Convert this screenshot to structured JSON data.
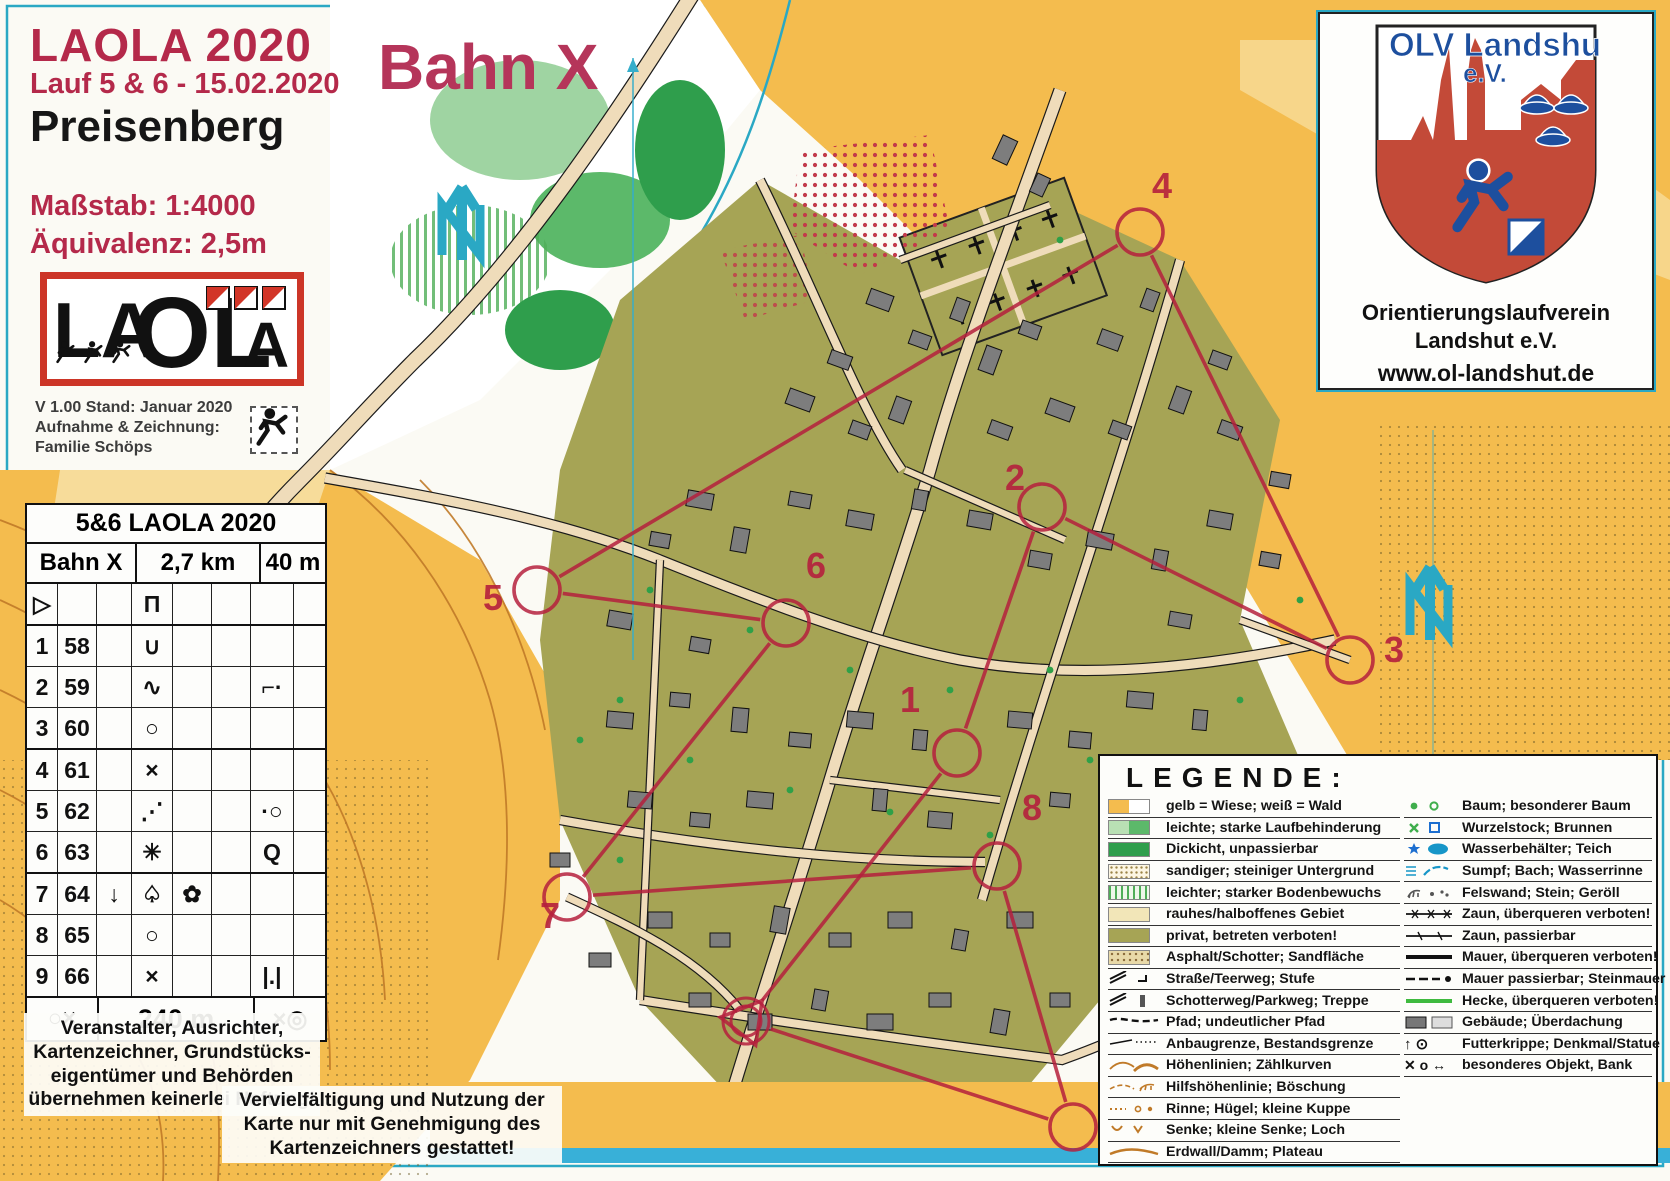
{
  "header": {
    "title": "LAOLA 2020",
    "subtitle": "Lauf 5 & 6 - 15.02.2020",
    "place": "Preisenberg",
    "scale": "Maßstab: 1:4000",
    "equivalence": "Äquivalenz: 2,5m"
  },
  "course_title": "Bahn X",
  "logo": {
    "part1": "LA",
    "part2": "OL",
    "part3": "A"
  },
  "version": {
    "line1": "V 1.00 Stand: Januar 2020",
    "line2": "Aufnahme & Zeichnung:",
    "line3": "Familie Schöps"
  },
  "control_card": {
    "title": "5&6 LAOLA 2020",
    "course": "Bahn X",
    "length": "2,7 km",
    "climb": "40 m",
    "rows": [
      {
        "num": "",
        "code": "",
        "c": "",
        "d": "Π",
        "e": "",
        "g": "",
        "start": true
      },
      {
        "num": "1",
        "code": "58",
        "c": "",
        "d": "∪",
        "e": "",
        "g": ""
      },
      {
        "num": "2",
        "code": "59",
        "c": "",
        "d": "∿",
        "e": "",
        "g": "⌐·"
      },
      {
        "num": "3",
        "code": "60",
        "c": "",
        "d": "○",
        "e": "",
        "g": ""
      },
      {
        "num": "4",
        "code": "61",
        "c": "",
        "d": "×",
        "e": "",
        "g": ""
      },
      {
        "num": "5",
        "code": "62",
        "c": "",
        "d": "⋰",
        "e": "",
        "g": "·○"
      },
      {
        "num": "6",
        "code": "63",
        "c": "",
        "d": "✳",
        "e": "",
        "g": "Q"
      },
      {
        "num": "7",
        "code": "64",
        "c": "↓",
        "d": "♤",
        "e": "✿",
        "g": ""
      },
      {
        "num": "8",
        "code": "65",
        "c": "",
        "d": "○",
        "e": "",
        "g": ""
      },
      {
        "num": "9",
        "code": "66",
        "c": "",
        "d": "×",
        "e": "",
        "g": "|.|"
      }
    ],
    "start_symbol": "▷",
    "finish": {
      "left": "○×",
      "distance": "240 m",
      "right": "×◎"
    }
  },
  "disclaimers": {
    "liability": "Veranstalter, Ausrichter, Kartenzeichner, Grundstücks-eigentümer und Behörden übernehmen keinerlei Haftung!",
    "copyright": "Vervielfältigung und Nutzung der Karte nur mit Genehmigung des Kartenzeichners gestattet!"
  },
  "club": {
    "crest_title": "OLV Landshut",
    "crest_sub": "e.V.",
    "org_line1": "Orientierungslaufverein",
    "org_line2": "Landshut e.V.",
    "url": "www.ol-landshut.de"
  },
  "legend": {
    "title": "LEGENDE:",
    "left": [
      {
        "sym": "sw-wiese",
        "label": "gelb = Wiese; weiß = Wald"
      },
      {
        "sym": "sw-lauf",
        "label": "leichte; starke Laufbehinderung"
      },
      {
        "sym": "sw-dickicht",
        "label": "Dickicht, unpassierbar"
      },
      {
        "sym": "sw-sand",
        "label": "sandiger; steiniger Untergrund"
      },
      {
        "sym": "sw-boden",
        "label": "leichter; starker Bodenbewuchs"
      },
      {
        "sym": "sw-rauh",
        "label": "rauhes/halboffenes Gebiet"
      },
      {
        "sym": "sw-privat",
        "label": "privat, betreten verboten!"
      },
      {
        "sym": "sw-asphalt",
        "label": "Asphalt/Schotter; Sandfläche"
      },
      {
        "sym": "ln-strasse",
        "label": "Straße/Teerweg; Stufe"
      },
      {
        "sym": "ln-schotter",
        "label": "Schotterweg/Parkweg; Treppe"
      },
      {
        "sym": "ln-pfad",
        "label": "Pfad; undeutlicher Pfad"
      },
      {
        "sym": "ln-anbau",
        "label": "Anbaugrenze, Bestandsgrenze"
      },
      {
        "sym": "ln-hoehe",
        "label": "Höhenlinien; Zählkurven"
      },
      {
        "sym": "ln-hilfs",
        "label": "Hilfshöhenlinie; Böschung"
      },
      {
        "sym": "ln-rinne",
        "label": "Rinne; Hügel; kleine Kuppe"
      },
      {
        "sym": "ln-senke",
        "label": "Senke; kleine Senke; Loch"
      },
      {
        "sym": "ln-erdwall",
        "label": "Erdwall/Damm; Plateau"
      }
    ],
    "right": [
      {
        "sym": "pt-baum",
        "label": "Baum; besonderer Baum"
      },
      {
        "sym": "pt-wurzel",
        "label": "Wurzelstock; Brunnen"
      },
      {
        "sym": "pt-wasser",
        "label": "Wasserbehälter; Teich"
      },
      {
        "sym": "pt-sumpf",
        "label": "Sumpf; Bach; Wasserrinne"
      },
      {
        "sym": "pt-fels",
        "label": "Felswand; Stein; Geröll"
      },
      {
        "sym": "ln-zaunv",
        "label": "Zaun, überqueren verboten!"
      },
      {
        "sym": "ln-zaunp",
        "label": "Zaun, passierbar"
      },
      {
        "sym": "ln-mauerv",
        "label": "Mauer, überqueren verboten!"
      },
      {
        "sym": "ln-mauerp",
        "label": "Mauer passierbar; Steinmauer"
      },
      {
        "sym": "ln-hecke",
        "label": "Hecke, überqueren verboten!"
      },
      {
        "sym": "pt-gebaeude",
        "label": "Gebäude; Überdachung"
      },
      {
        "sym": "pt-krippe",
        "label": "Futterkrippe; Denkmal/Statue"
      },
      {
        "sym": "pt-objekt",
        "label": "besonderes Objekt, Bank"
      }
    ]
  },
  "map": {
    "course_color": "#b5203d",
    "north_color": "#2aa8c4",
    "start_finish": {
      "x": 746,
      "y": 1021
    },
    "controls": [
      {
        "num": "1",
        "cx": 957,
        "cy": 753,
        "lx": 900,
        "ly": 712
      },
      {
        "num": "2",
        "cx": 1042,
        "cy": 507,
        "lx": 1005,
        "ly": 490
      },
      {
        "num": "3",
        "cx": 1350,
        "cy": 660,
        "lx": 1384,
        "ly": 662
      },
      {
        "num": "4",
        "cx": 1140,
        "cy": 232,
        "lx": 1152,
        "ly": 198
      },
      {
        "num": "5",
        "cx": 537,
        "cy": 590,
        "lx": 483,
        "ly": 610
      },
      {
        "num": "6",
        "cx": 786,
        "cy": 623,
        "lx": 806,
        "ly": 578
      },
      {
        "num": "7",
        "cx": 567,
        "cy": 897,
        "lx": 540,
        "ly": 928
      },
      {
        "num": "8",
        "cx": 997,
        "cy": 866,
        "lx": 1022,
        "ly": 820
      },
      {
        "num": "9",
        "cx": 1073,
        "cy": 1127,
        "lx": 1106,
        "ly": 1110
      }
    ]
  }
}
